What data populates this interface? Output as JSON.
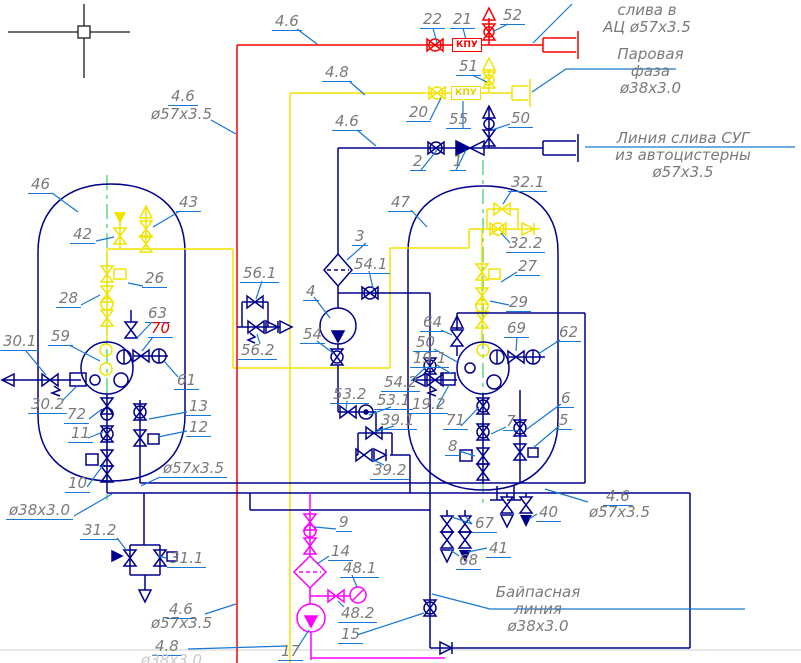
{
  "colors": {
    "pipe_red": "#fa0000",
    "pipe_yellow": "#f0e400",
    "pipe_navy": "#00008b",
    "pipe_magenta": "#ff00ff",
    "leader_blue": "#1777d2",
    "centerline_green": "#35d06a",
    "label_gray": "#7a7a7a"
  },
  "labels": [
    {
      "t": "22",
      "x": 420,
      "y": 11
    },
    {
      "t": "21",
      "x": 450,
      "y": 11
    },
    {
      "t": "52",
      "x": 500,
      "y": 7
    },
    {
      "t": "51",
      "x": 456,
      "y": 58
    },
    {
      "t": "20",
      "x": 406,
      "y": 104
    },
    {
      "t": "55",
      "x": 446,
      "y": 111
    },
    {
      "t": "50",
      "x": 508,
      "y": 110
    },
    {
      "t": "2",
      "x": 410,
      "y": 153
    },
    {
      "t": "1",
      "x": 450,
      "y": 153
    },
    {
      "t": "4.6",
      "x": 272,
      "y": 13
    },
    {
      "t": "4.8",
      "x": 322,
      "y": 64
    },
    {
      "t": "4.6",
      "x": 332,
      "y": 113
    },
    {
      "t": "4.6",
      "x": 168,
      "y": 88
    },
    {
      "t": "ø57x3.5",
      "x": 148,
      "y": 106,
      "cls": "noul"
    },
    {
      "t": "46",
      "x": 28,
      "y": 176
    },
    {
      "t": "43",
      "x": 176,
      "y": 194
    },
    {
      "t": "42",
      "x": 70,
      "y": 226
    },
    {
      "t": "26",
      "x": 142,
      "y": 270
    },
    {
      "t": "28",
      "x": 56,
      "y": 290
    },
    {
      "t": "63",
      "x": 145,
      "y": 305
    },
    {
      "t": "70",
      "x": 148,
      "y": 320,
      "cls": "red"
    },
    {
      "t": "59",
      "x": 48,
      "y": 328
    },
    {
      "t": "30.1",
      "x": 0,
      "y": 333
    },
    {
      "t": "30.2",
      "x": 28,
      "y": 396
    },
    {
      "t": "72",
      "x": 64,
      "y": 406
    },
    {
      "t": "11",
      "x": 68,
      "y": 425
    },
    {
      "t": "13",
      "x": 186,
      "y": 398
    },
    {
      "t": "12",
      "x": 186,
      "y": 419
    },
    {
      "t": "10",
      "x": 65,
      "y": 475
    },
    {
      "t": "61",
      "x": 174,
      "y": 372
    },
    {
      "t": "ø57x3.5",
      "x": 160,
      "y": 460
    },
    {
      "t": "ø38x3.0",
      "x": 6,
      "y": 502
    },
    {
      "t": "31.2",
      "x": 80,
      "y": 522
    },
    {
      "t": "31.1",
      "x": 167,
      "y": 550
    },
    {
      "t": "47",
      "x": 388,
      "y": 194
    },
    {
      "t": "32.1",
      "x": 508,
      "y": 174
    },
    {
      "t": "32.2",
      "x": 506,
      "y": 235
    },
    {
      "t": "27",
      "x": 515,
      "y": 258
    },
    {
      "t": "29",
      "x": 506,
      "y": 294
    },
    {
      "t": "64",
      "x": 420,
      "y": 314
    },
    {
      "t": "69",
      "x": 504,
      "y": 320
    },
    {
      "t": "62",
      "x": 556,
      "y": 324
    },
    {
      "t": "50",
      "x": 413,
      "y": 334
    },
    {
      "t": "19.1",
      "x": 410,
      "y": 350
    },
    {
      "t": "19.2",
      "x": 409,
      "y": 396
    },
    {
      "t": "54.2",
      "x": 381,
      "y": 374
    },
    {
      "t": "53.2",
      "x": 330,
      "y": 386
    },
    {
      "t": "53.1",
      "x": 374,
      "y": 392
    },
    {
      "t": "39.1",
      "x": 378,
      "y": 412
    },
    {
      "t": "71",
      "x": 443,
      "y": 412
    },
    {
      "t": "7",
      "x": 503,
      "y": 413
    },
    {
      "t": "8",
      "x": 445,
      "y": 438
    },
    {
      "t": "6",
      "x": 558,
      "y": 390
    },
    {
      "t": "5",
      "x": 556,
      "y": 412
    },
    {
      "t": "39.2",
      "x": 370,
      "y": 462
    },
    {
      "t": "3",
      "x": 352,
      "y": 228
    },
    {
      "t": "54.1",
      "x": 351,
      "y": 256
    },
    {
      "t": "4",
      "x": 303,
      "y": 283
    },
    {
      "t": "54",
      "x": 300,
      "y": 326
    },
    {
      "t": "56.1",
      "x": 240,
      "y": 265
    },
    {
      "t": "56.2",
      "x": 238,
      "y": 342
    },
    {
      "t": "67",
      "x": 472,
      "y": 515
    },
    {
      "t": "68",
      "x": 456,
      "y": 552
    },
    {
      "t": "41",
      "x": 486,
      "y": 540
    },
    {
      "t": "40",
      "x": 536,
      "y": 504
    },
    {
      "t": "4.6",
      "x": 603,
      "y": 488
    },
    {
      "t": "ø57x3.5",
      "x": 586,
      "y": 504,
      "cls": "noul"
    },
    {
      "t": "9",
      "x": 336,
      "y": 514
    },
    {
      "t": "14",
      "x": 328,
      "y": 543
    },
    {
      "t": "48.1",
      "x": 340,
      "y": 560
    },
    {
      "t": "48.2",
      "x": 338,
      "y": 605
    },
    {
      "t": "15",
      "x": 338,
      "y": 626
    },
    {
      "t": "17",
      "x": 278,
      "y": 643
    },
    {
      "t": "4.6",
      "x": 166,
      "y": 601
    },
    {
      "t": "ø57x3.5",
      "x": 148,
      "y": 615,
      "cls": "noul"
    },
    {
      "t": "4.8",
      "x": 152,
      "y": 638
    },
    {
      "t": "КПУ",
      "x": 452,
      "y": 38,
      "cls": "kpu r"
    },
    {
      "t": "КПУ",
      "x": 451,
      "y": 86,
      "cls": "kpu y"
    },
    {
      "t": "ø38x3.0",
      "x": 138,
      "y": 652,
      "cls": "faint"
    }
  ],
  "notes": [
    {
      "id": "note-drain-to-truck",
      "x": 592,
      "y": 2,
      "w": 110,
      "lines": [
        "слива в",
        "АЦ ø57x3.5"
      ]
    },
    {
      "id": "note-vapor-phase",
      "x": 598,
      "y": 46,
      "w": 105,
      "lines": [
        "Паровая",
        "фаза",
        "ø38x3.0"
      ]
    },
    {
      "id": "note-lpg-unload-line",
      "x": 572,
      "y": 130,
      "w": 222,
      "lines": [
        "Линия слива СУГ",
        "из автоцистерны",
        "ø57x3.5"
      ]
    },
    {
      "id": "note-bypass-line",
      "x": 482,
      "y": 584,
      "w": 112,
      "lines": [
        "Байпасная",
        "линия",
        "ø38x3.0"
      ]
    }
  ]
}
